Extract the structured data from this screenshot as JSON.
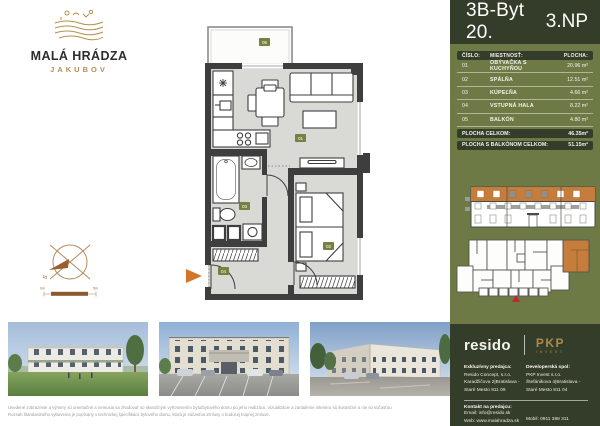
{
  "logo": {
    "title": "MALÁ HRÁDZA",
    "subtitle": "JAKUBOV"
  },
  "header": {
    "unit": "3B-Byt 20.",
    "floor": "3.NP"
  },
  "rooms_table": {
    "col_num": "ČÍSLO:",
    "col_name": "MIESTNOSŤ:",
    "col_area": "PLOCHA:",
    "rows": [
      {
        "num": "01",
        "name": "OBÝVAČKA S KUCHYŇOU",
        "area": "20.96 m²"
      },
      {
        "num": "02",
        "name": "SPÁLŇA",
        "area": "12.51 m²"
      },
      {
        "num": "03",
        "name": "KÚPEĽŇA",
        "area": "4.66 m²"
      },
      {
        "num": "04",
        "name": "VSTUPNÁ HALA",
        "area": "8.22 m²"
      },
      {
        "num": "05",
        "name": "BALKÓN",
        "area": "4.80 m²"
      }
    ],
    "total_label": "PLOCHA CELKOM:",
    "total_value": "46.35m²",
    "total_balcony_label": "PLOCHA S BALKÓNOM CELKOM:",
    "total_balcony_value": "51.15m²"
  },
  "floorplan": {
    "north_label": "S",
    "scale_start": "0m",
    "scale_end": "5m"
  },
  "contact": {
    "resido_logo": "resido",
    "pkp_logo": "PKP",
    "pkp_sub": "INVEST",
    "seller_label": "Exkluzívny predajca:",
    "seller_name": "Resido Concept, s.r.o.",
    "seller_addr1": "Karadžičova 2|Bratislava -",
    "seller_addr2": "Staré Mesto 811 09",
    "developer_label": "Developerská spol:",
    "developer_name": "PKP Invest s.r.o.",
    "developer_addr1": "Štefánikova 4|Bratislava -",
    "developer_addr2": "Staré Mesto 811 04",
    "contact_label": "Kontakt na predajcu:",
    "email": "Email: info@resido.sk",
    "web": "Web: www.malahradza.sk",
    "mobile": "Mobil: 0911 388 311"
  },
  "disclaimer": {
    "line1": "Uvedené zobrazenie a výmery sú orientačné a nemusia sa zhodovať so skutočným vyhotovením bytu/bytového domu po jeho realizácii. Vizualizácie a zariadenie interiéru sú ilustračné a nie sú súčasťou",
    "line2": "Rozsah štandardného vybavenia je popísaný v technickej špecifikácii bytového domu, ktorá je súčasťou Zmluvy o budúcej kúpnej zmluve."
  }
}
